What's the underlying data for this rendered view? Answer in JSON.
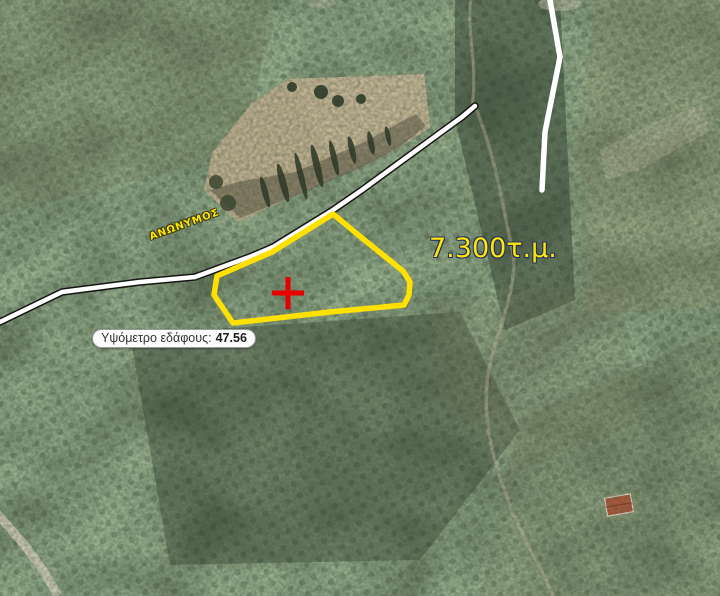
{
  "map": {
    "street_label": "ΑΝΩΝΥΜΟΣ",
    "area_label": "7.300τ.μ.",
    "elevation_tooltip": {
      "label": "Υψόμετρο εδάφους:",
      "value": "47.56"
    }
  },
  "parcel": {
    "points": "333,214 362,238 388,259 403,271 410,282 409,295 404,305 330,312 233,323 214,295 217,276 272,252",
    "stroke_color": "#ffe100",
    "area_text": "7.300τ.μ."
  },
  "marker": {
    "transform": "translate(288,293)",
    "color": "#e60000"
  },
  "roads": {
    "main_path": "M0,322 L62,292 L140,282 L195,277 L252,256 L273,247 L333,210 L362,190 L440,133 L462,117 L475,106",
    "secondary_path": "M550,0 L560,57 L545,132 L542,190",
    "surface_color": "#ffffff",
    "casing_color": "#151515"
  },
  "colors": {
    "label_yellow": "#ffe600",
    "label_outline_navy": "#223064",
    "tooltip_background": "#fcfcfc",
    "tooltip_text": "#333333",
    "field_tan": "#c3b293",
    "roof_red": "#b0583c"
  }
}
